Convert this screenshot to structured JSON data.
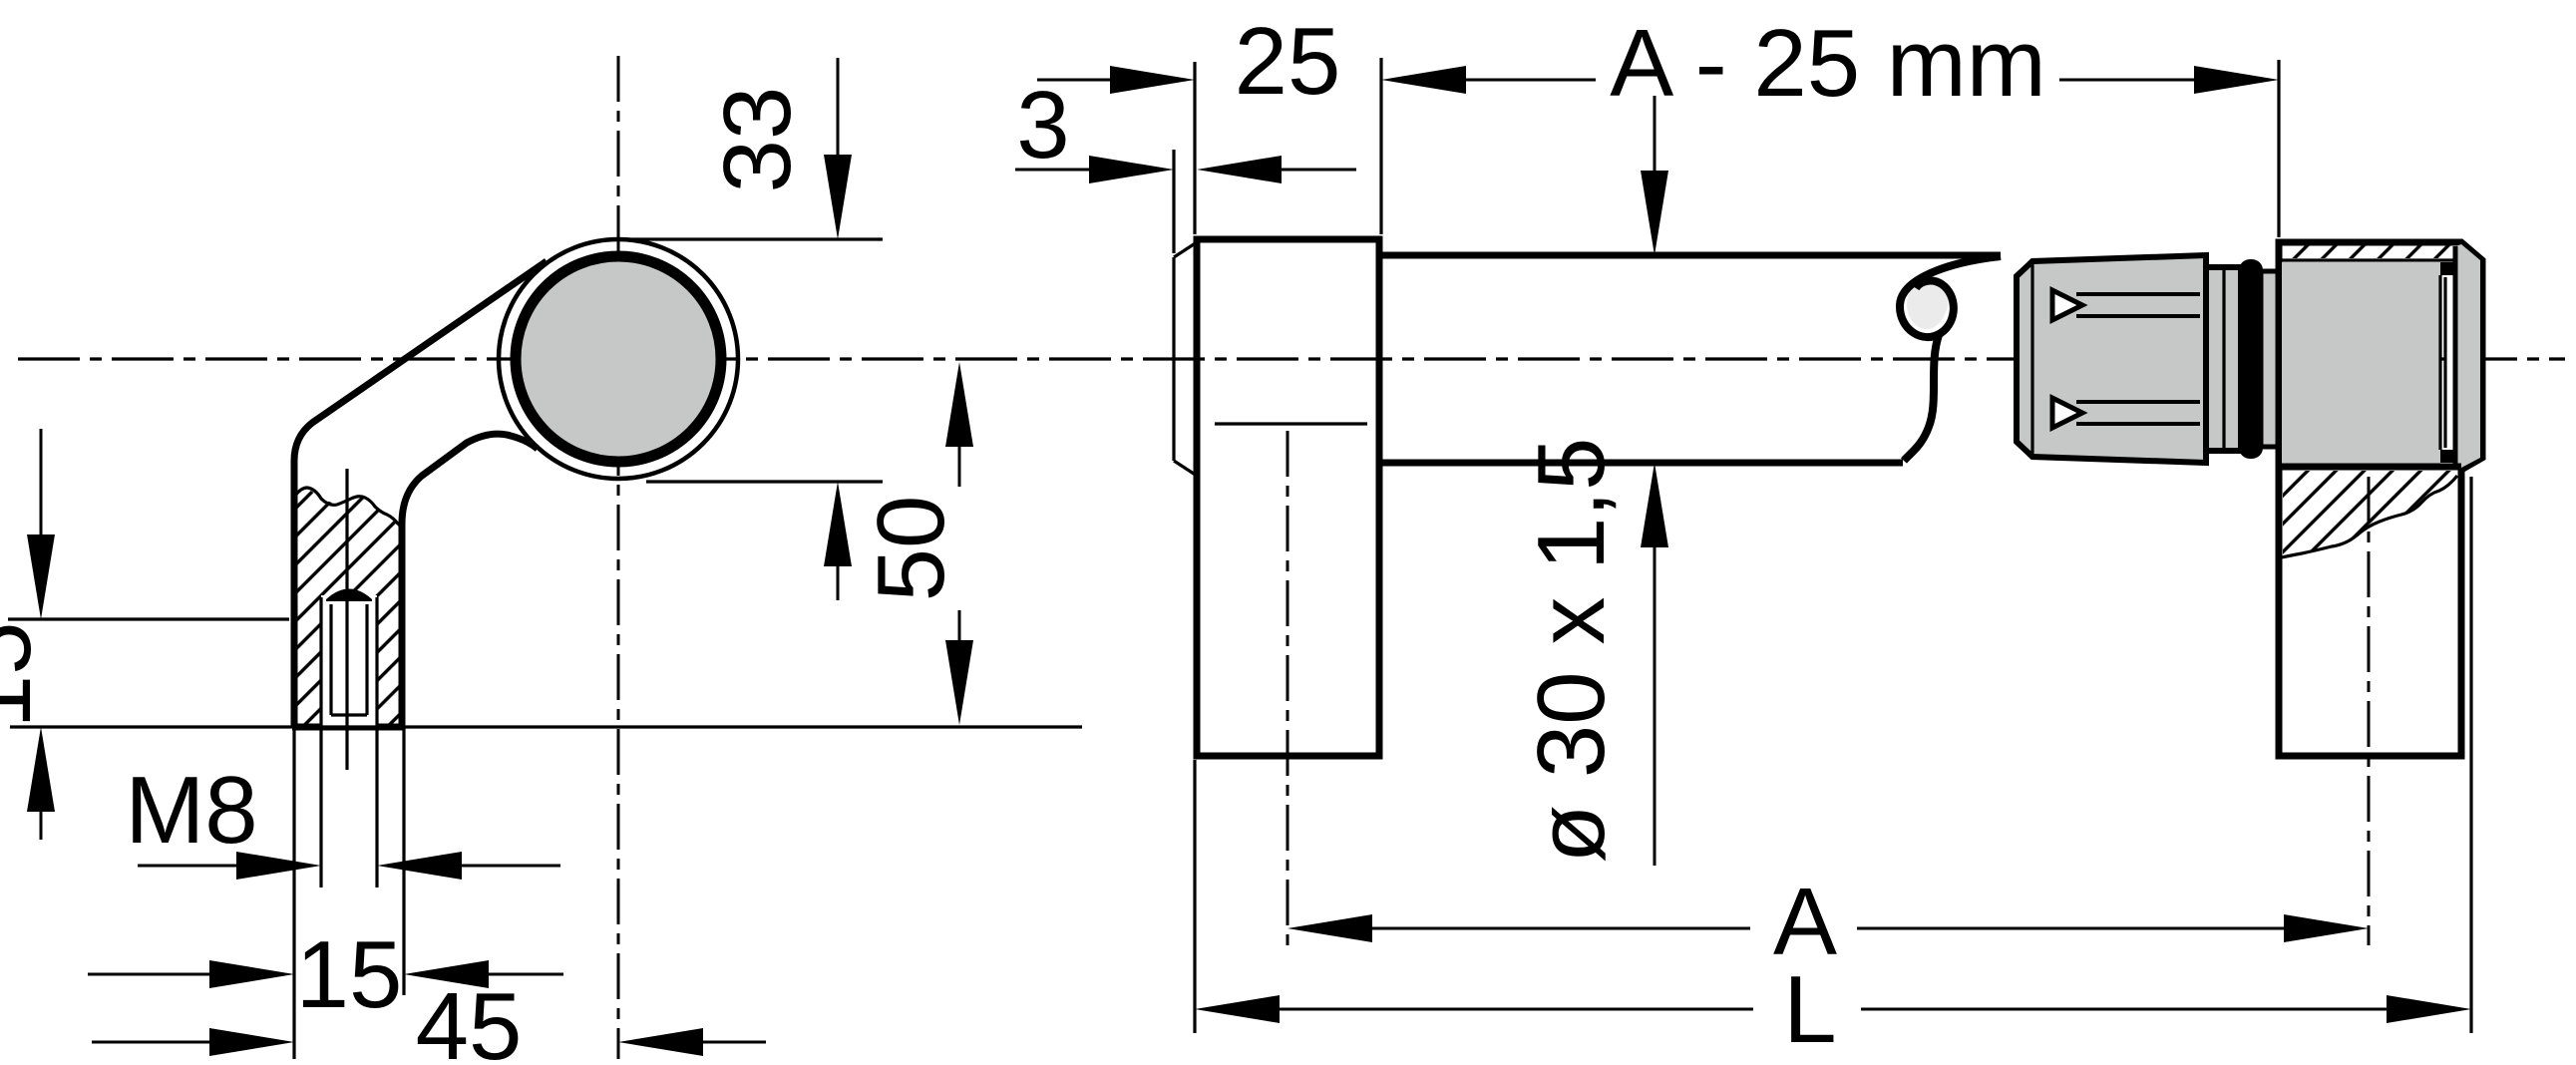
{
  "drawing": {
    "title": "handle technical drawing, side view and front view",
    "side_view": {
      "dims": {
        "ring_od": "33",
        "axis_height": "50",
        "foot_height": "15",
        "thread": "M8",
        "foot_width": "15",
        "center_offset": "45"
      }
    },
    "front_view": {
      "dims": {
        "shoe_width": "25",
        "face_plate": "3",
        "grip_length": "A - 25 mm",
        "tube_spec": "ø 30 x 1,5",
        "hole_distance": "A",
        "total_length": "L"
      }
    },
    "colors": {
      "line": "#000000",
      "part_gray": "#c6c8c8",
      "break_gray": "#ebebeb",
      "background": "#ffffff"
    }
  }
}
